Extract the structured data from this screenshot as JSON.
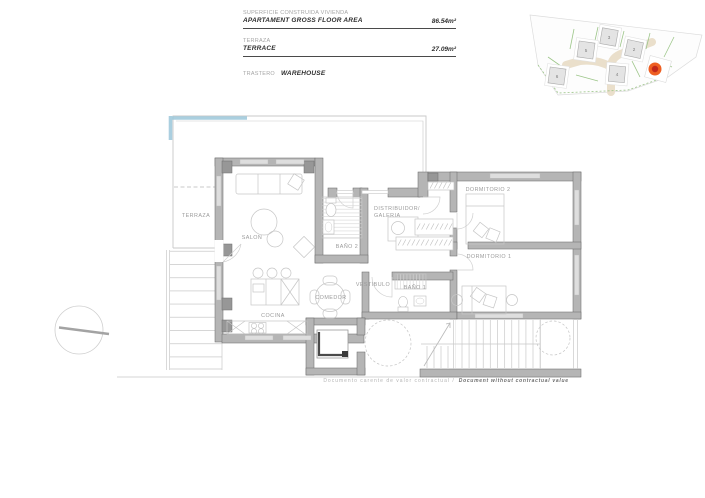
{
  "info_block": {
    "rows": [
      {
        "label_primary": "SUPERFICIE CONSTRUIDA VIVIENDA",
        "label_secondary": "APARTAMENT GROSS FLOOR AREA",
        "value": "86.54m²"
      },
      {
        "label_primary": "TERRAZA",
        "label_secondary": "TERRACE",
        "value": "27.09m²"
      },
      {
        "label_primary": "TRASTERO",
        "label_secondary": "WAREHOUSE",
        "value": ""
      }
    ]
  },
  "site_plan": {
    "unit_numbers": [
      "3",
      "5",
      "2",
      "4",
      "6"
    ],
    "marker_color": "#ee5f22",
    "marker_inner_color": "#c1281b",
    "green": "#9cc588",
    "road": "#eadfcb"
  },
  "floor_plan": {
    "labels": {
      "terraza": "TERRAZA",
      "salon": "SALON",
      "bano2": "BAÑO 2",
      "distribuidor_line1": "DISTRIBUIDOR/",
      "distribuidor_line2": "GALERIA",
      "dormitorio2": "DORMITORIO 2",
      "dormitorio1": "DORMITORIO 1",
      "vestibulo": "VESTIBULO",
      "bano1": "BAÑO 1",
      "comedor": "COMEDOR",
      "cocina": "COCINA"
    },
    "colors": {
      "wall": "#b5b5b5",
      "accent_blue": "#9cc7da"
    }
  },
  "footer": {
    "disclaimer_primary": "Documento carente de valor contractual /",
    "disclaimer_secondary": "Document without contractual value"
  }
}
